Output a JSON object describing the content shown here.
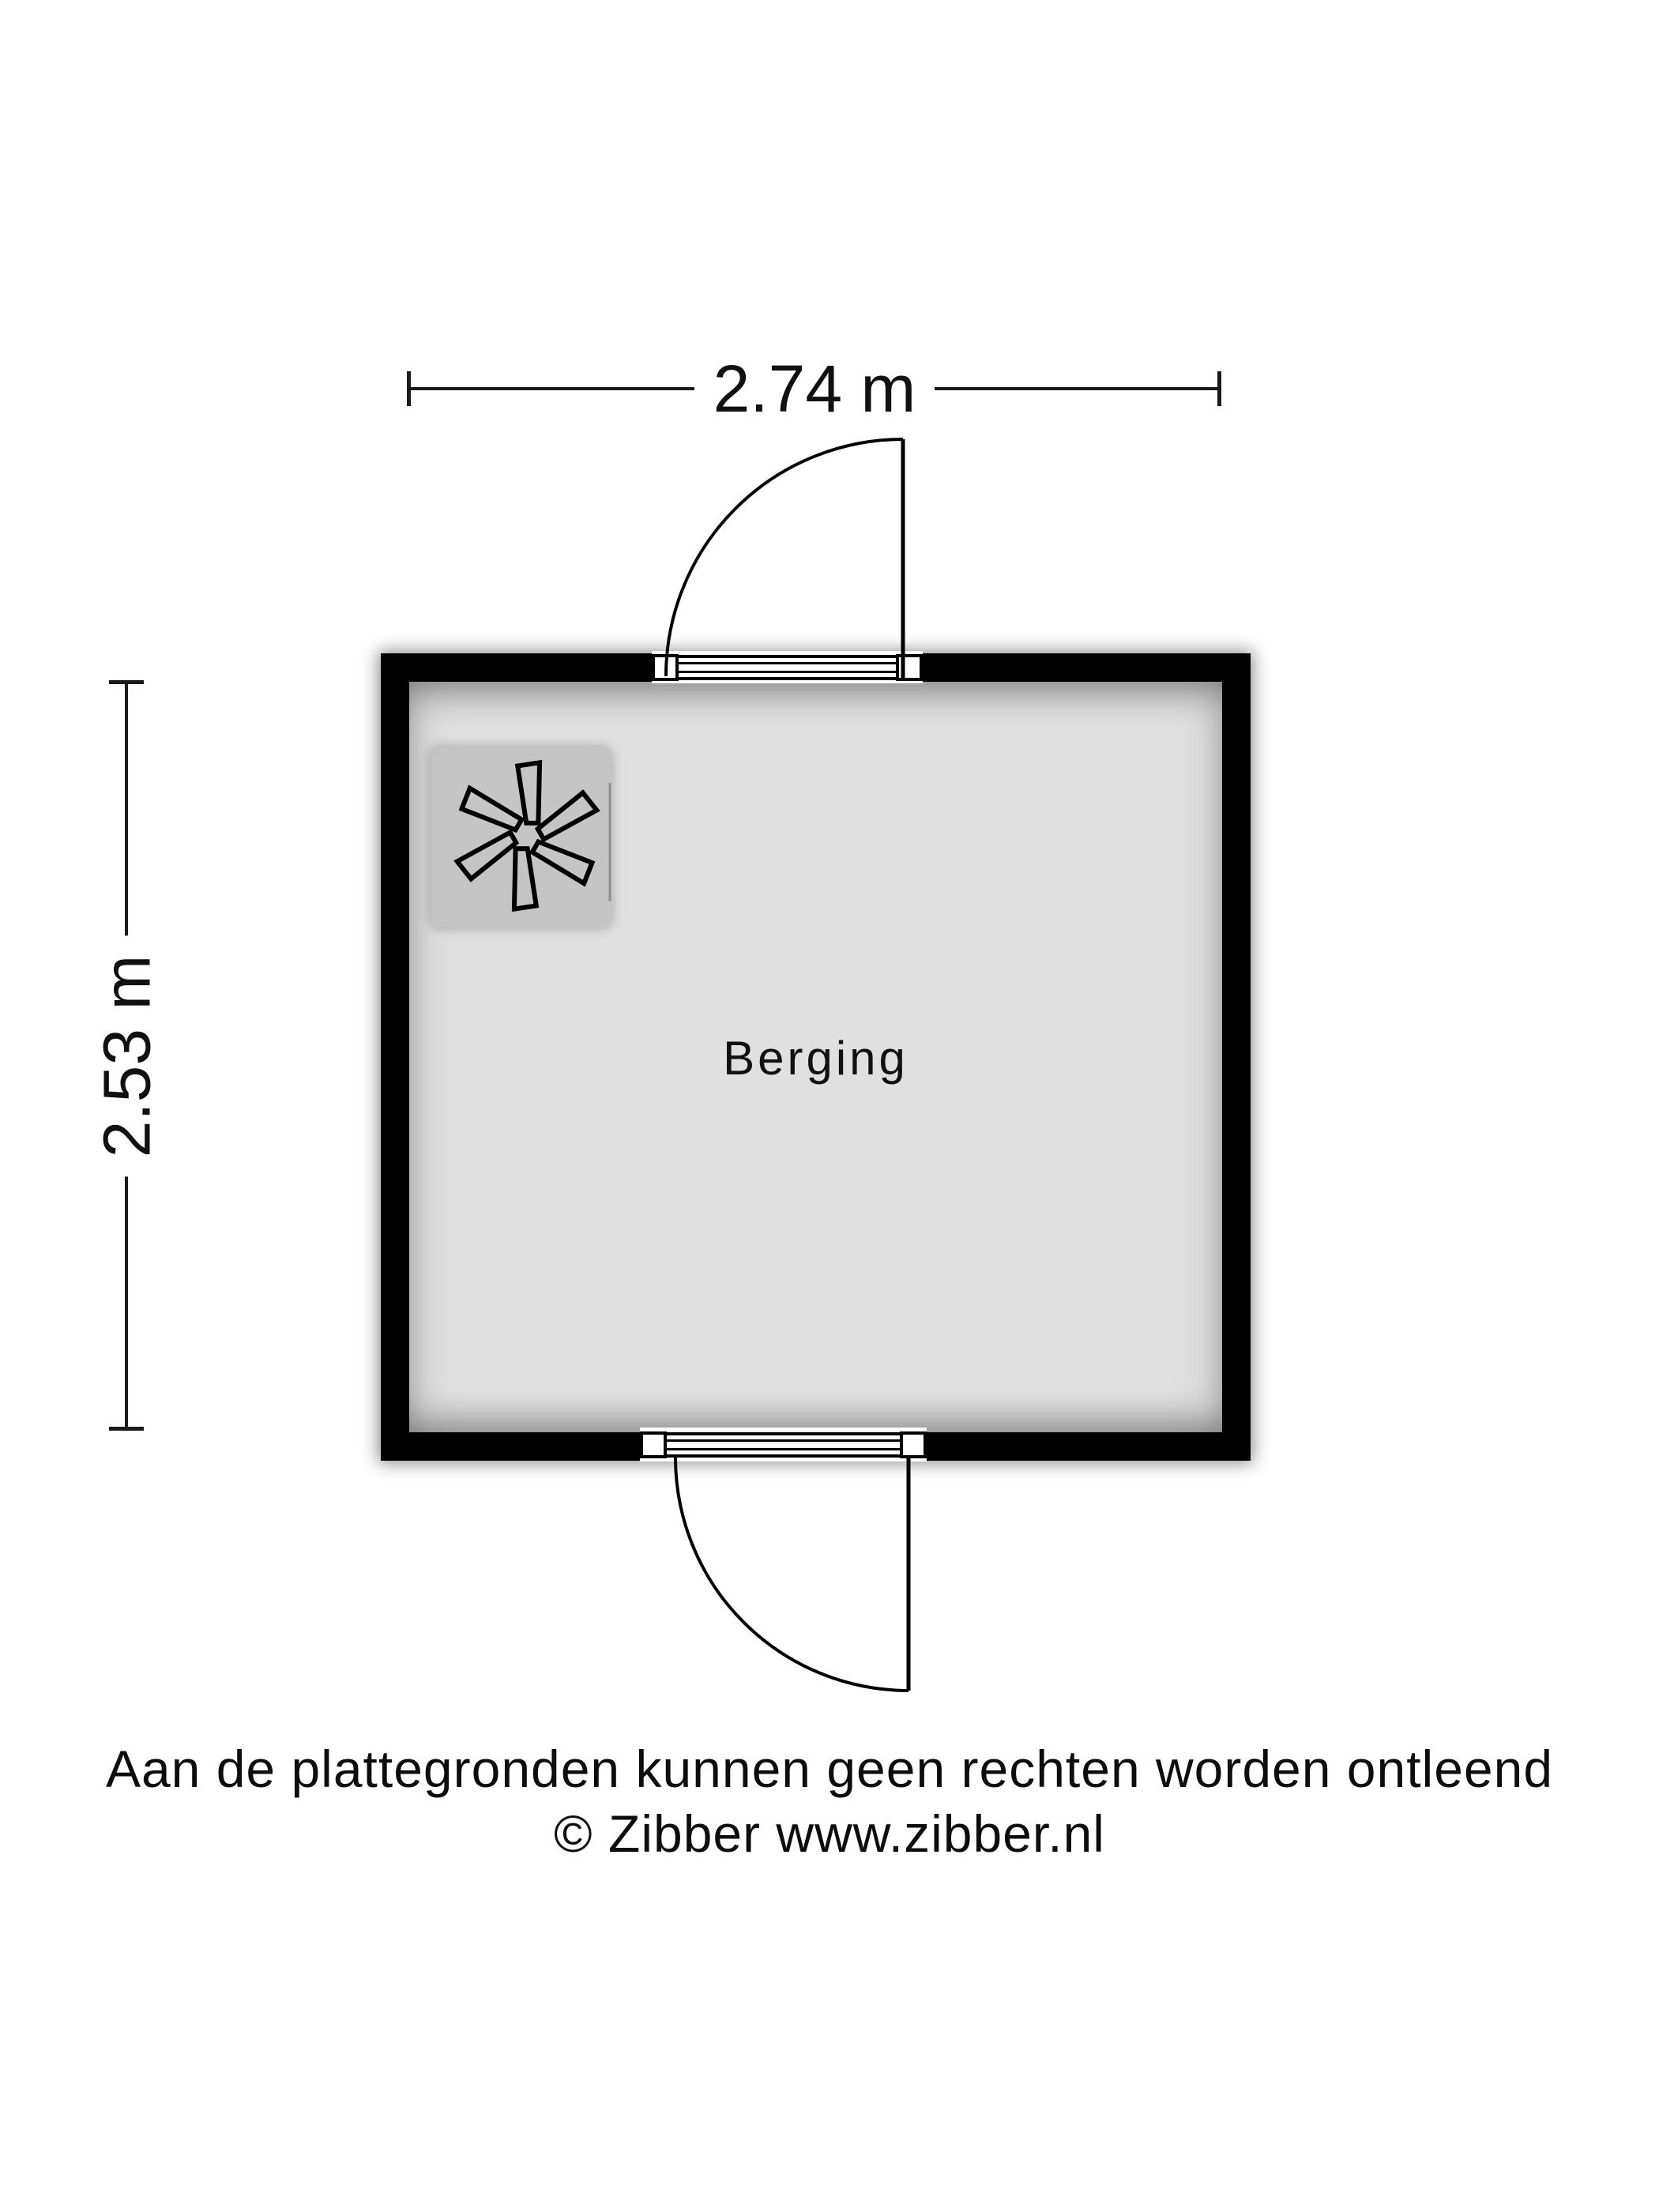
{
  "floorplan": {
    "room": {
      "label": "Berging"
    },
    "dimensions": {
      "width_label": "2.74 m",
      "height_label": "2.53 m"
    },
    "symbols": {
      "ventilation_unit": "fan-icon"
    },
    "colors": {
      "wall": "#000000",
      "floor": "#e0e0e0",
      "unit_tile": "#c5c5c5",
      "dimension_line": "#1a1a1a",
      "background": "#ffffff"
    }
  },
  "footer": {
    "line1": "Aan de plattegronden kunnen geen rechten worden ontleend",
    "line2": "© Zibber www.zibber.nl"
  }
}
